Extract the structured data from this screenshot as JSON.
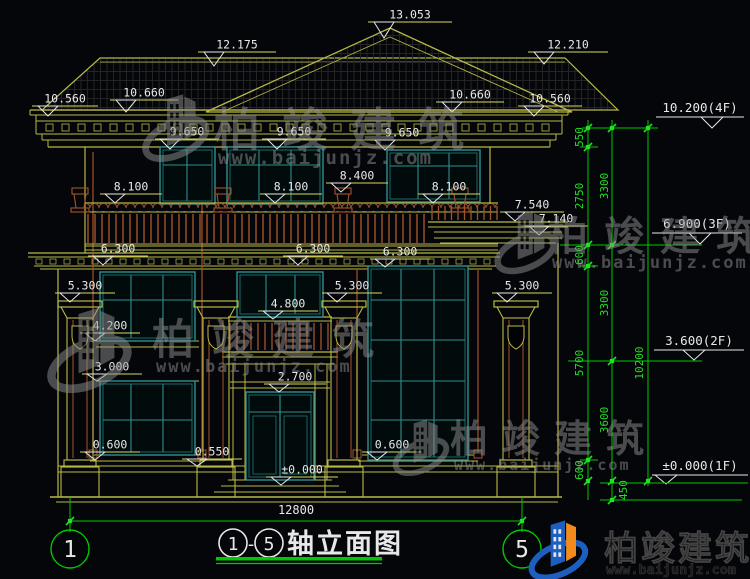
{
  "drawing_type": "building front elevation CAD drawing",
  "palette": {
    "bg": "#05060a",
    "yellow": "#b9b944",
    "yellow_bright": "#d8d85e",
    "teal": "#2f8f8f",
    "teal_dark": "#1d6a6a",
    "green": "#00c800",
    "green_bright": "#22e022",
    "brown": "#a2552b",
    "white": "#e8e8e8",
    "watermark_gray": "#8f8f8f",
    "logo_blue": "#1d5fc0",
    "logo_orange": "#f28a1c",
    "dark_text": "#161616",
    "hatch": "#242424"
  },
  "levels": [
    "13.053",
    "12.175",
    "12.210",
    "10.560",
    "10.660",
    "10.660",
    "10.560",
    "9.650",
    "9.650",
    "9.650",
    "8.100",
    "8.100",
    "8.400",
    "8.100",
    "7.540",
    "7.140",
    "6.300",
    "6.300",
    "6.300",
    "5.300",
    "5.300",
    "5.300",
    "4.800",
    "4.200",
    "3.000",
    "2.700",
    "0.600",
    "0.550",
    "0.600",
    "±0.000"
  ],
  "floor_levels": [
    "10.200(4F)",
    "6.900(3F)",
    "3.600(2F)",
    "±0.000(1F)"
  ],
  "dims": {
    "chain_inner": [
      "550",
      "2750",
      "600",
      "5700",
      "600"
    ],
    "chain_floor": [
      "3300",
      "3300",
      "3600"
    ],
    "below_ground": "450",
    "total_height": "10200",
    "total_width": "12800"
  },
  "axes": {
    "start": "1",
    "end": "5"
  },
  "title": {
    "axis_start": "1",
    "separator": "-",
    "axis_end": "5",
    "name": "轴立面图"
  },
  "watermark": {
    "brand": "柏竣建筑",
    "url": "www.baijunjz.com"
  }
}
